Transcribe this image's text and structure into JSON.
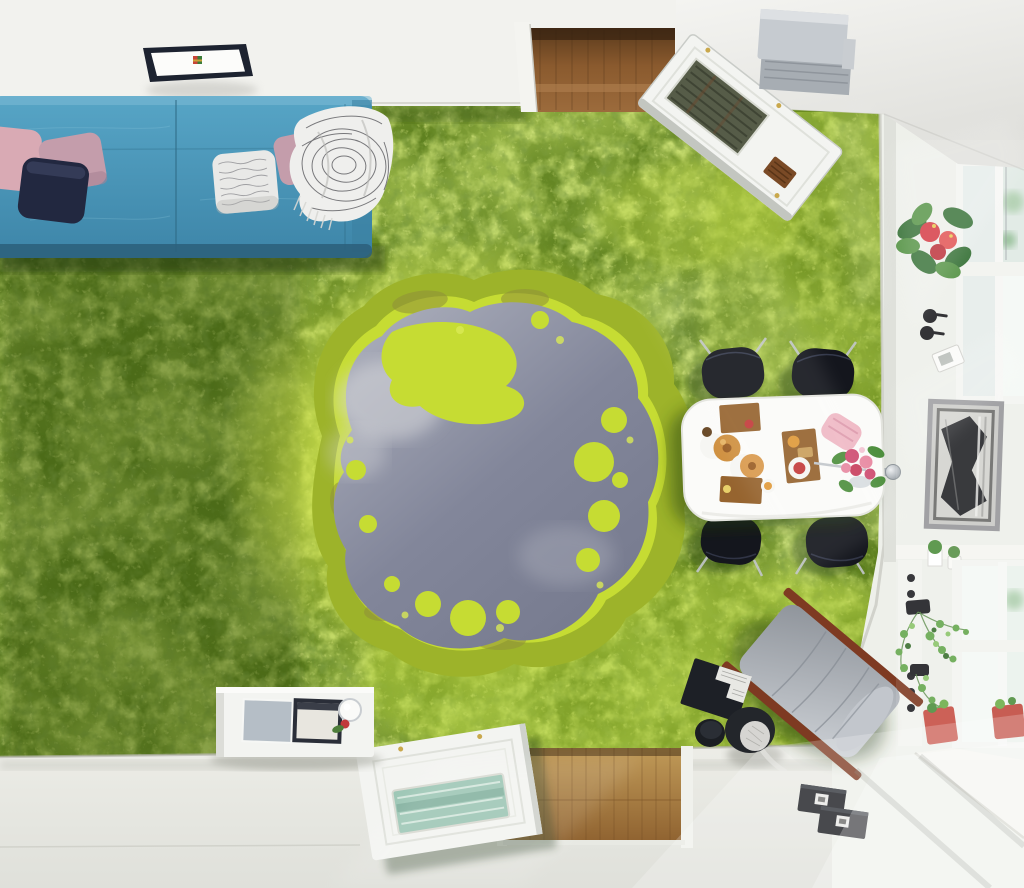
{
  "meta": {
    "kind": "interior render, top-down view",
    "subject": "room with 3D aerial-forest sinkhole-lake floor mural",
    "width_px": 1024,
    "height_px": 888
  },
  "labels": {
    "scene": "Top-down room interior with 3D forest-lake floor mural",
    "forest_mural": "Aerial rainforest canopy floor mural",
    "lake": "Grey sinkhole lake with cloud reflections",
    "algae_ring": "Bright algae ring around lake",
    "top_wall": "White wall along top edge",
    "ceiling_lamp": "Square black-framed ceiling lamp",
    "top_doorway": "Open doorway with wooden hall floor",
    "top_door": "Open white door with louvered glass panel",
    "ac_unit": "Grey wall-mounted unit near ceiling",
    "ceiling": "Ceiling corner at top right",
    "sofa": "Blue fabric sofa",
    "pillow_pink_far": "Pink cushion",
    "pillow_mauve": "Mauve cushion",
    "pillow_navy": "Dark navy cushion",
    "pillow_pattern": "White patterned cushion",
    "pillow_mauve_right": "Mauve cushion under throw",
    "sofa_throw": "White patterned throw blanket with fringe",
    "dining_set": "White dining table with four black chairs",
    "dining_table": "White oval dining table",
    "dining_chair": "Black shell dining chair",
    "breakfast_items": "Breakfast boards, pastries and plates",
    "flower_bouquet": "Pink rose bouquet",
    "napkin": "Pink napkin",
    "right_wall": "Window wall with decor",
    "upper_window": "Upper window with bright glass",
    "lower_window": "Lower window with bright glass",
    "anthurium": "Red anthurium plant on wall ledge",
    "wall_hooks": "Two round black wall hooks",
    "thermostat": "White wall control panel",
    "artwork": "Framed black-and-white horse artwork",
    "door_knob": "Chrome door knob",
    "shelf_plants": "Small potted plants on sill",
    "dotted_board": "White trim board with black dots",
    "ivy_plant": "Hanging ivy in black pots",
    "red_planters": "Red window planters with herbs",
    "bottom_floor": "White floor with sunlight patches",
    "window_floor": "Sunlit floor step by window",
    "wood_threshold": "Wooden threshold of bottom doorway",
    "bottom_door": "Open white door with glass insert",
    "sideboard": "White sideboard",
    "media_screens": "Grey panel and dark screen on sideboard",
    "table_lamp": "Round white lamp with red flower",
    "lounge_chair": "Grey lounge chair with wooden rails",
    "open_book": "Open dark book on floor",
    "stool_large": "Dark drum stool with concrete top",
    "stool_small": "Small dark drum stool",
    "floor_books": "Two black books on white floor",
    "sunlight": "Diagonal sunlight streaks"
  },
  "counts": {
    "dining_chairs": 4,
    "sofa_cushions": 5,
    "wall_hooks": 2,
    "red_planters": 2,
    "floor_books": 2,
    "shelf_plants": 3
  },
  "palette": {
    "forestBase": "#5f8120",
    "forestDark": "#3e5c12",
    "forestDeep": "#2c4410",
    "forestLight": "#8fb32a",
    "forestBright": "#b9d63e",
    "algae": "#c6dc33",
    "algaeDeep": "#9db32a",
    "marshBrown": "#8f8f3a",
    "water": "#82869a",
    "waterLight": "#b0b3bf",
    "cloudWhite": "#d8d9dc",
    "wallWhite": "#f2f2ee",
    "ceilingGrey": "#e0e0dc",
    "floorWhite": "#eaebe5",
    "floorShadow": "#c9cac2",
    "woodFloor": "#9c6b3c",
    "woodDark": "#4a2f16",
    "woodThreshold": "#c09a58",
    "sofaBlue": "#57a5c6",
    "sofaBlueDark": "#3d85a8",
    "sofaShadow": "#2c5f7a",
    "pillowPink": "#d9aab4",
    "pillowMauve": "#c49dab",
    "pillowNavy": "#222840",
    "pillowWhite": "#e9e9e7",
    "patternGrey": "#85858a",
    "throwWhite": "#efefed",
    "throwBlack": "#2a2a30",
    "lampFrame": "#1d2330",
    "doorWhite": "#f3f4f1",
    "doorEdge": "#cfd2cc",
    "louverDark": "#565c48",
    "grilleBrown": "#7a4a26",
    "hingeGold": "#c9a84c",
    "boxGrey": "#c6cbd0",
    "boxGreyDark": "#a7adb3",
    "tableWhite": "#fbfbf9",
    "chairBlack": "#14161d",
    "chrome": "#c3c7cb",
    "boardWood": "#96642f",
    "croissant": "#cf9040",
    "croissantDark": "#9a5e26",
    "plateWhite": "#f6f6f3",
    "jamRed": "#c43b3b",
    "orangeFruit": "#e09a3a",
    "napkinPink": "#efb9c5",
    "roseDeep": "#cf4e72",
    "rosePink": "#e88aa2",
    "leafGreen": "#4e8f3e",
    "leafDark": "#2e6b2e",
    "flowerRed": "#d42e38",
    "potBlack": "#1e1e22",
    "planterRed": "#c75044",
    "ivyGreen": "#66a84e",
    "frameSilver": "#97979a",
    "artDark": "#232428",
    "artLight": "#d3d3cf",
    "loungeGrey": "#b4b9bf",
    "loungeGreyDark": "#8e939a",
    "woodRail": "#7e3a22",
    "laptopBlack": "#1d2026",
    "stoolBlack": "#23262b",
    "furGrey": "#d6d5d2",
    "bookBlack": "#15171c",
    "glassTeal": "#9ec7b6",
    "glassBright": "#f4f9f5",
    "reflectGreen": "#aecfae",
    "knobChrome": "#c9ced2"
  }
}
